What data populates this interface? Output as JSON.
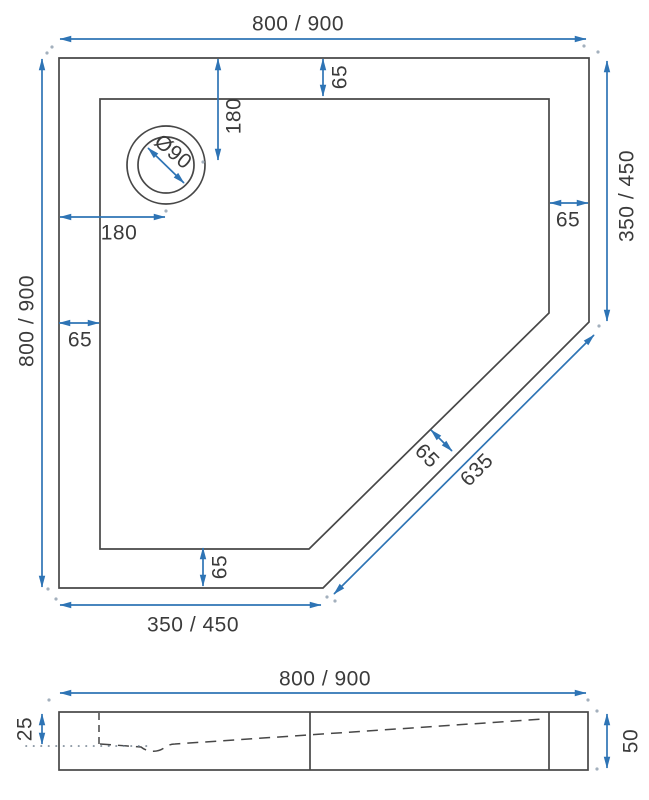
{
  "colors": {
    "outline": "#474747",
    "dimension_accent": "#2e74b5",
    "label_text": "#3b3b3b",
    "background": "#ffffff"
  },
  "top_view": {
    "labels": {
      "overall_width": "800 / 900",
      "overall_height": "800 / 900",
      "right_side": "350 / 450",
      "bottom_side": "350 / 450",
      "diagonal_side": "635",
      "rim_top": "65",
      "rim_left": "65",
      "rim_right": "65",
      "rim_bottom": "65",
      "rim_diagonal": "65",
      "drain_offset_vertical": "180",
      "drain_offset_horizontal": "180",
      "drain_diameter": "Ø90"
    }
  },
  "section_view": {
    "labels": {
      "overall_width": "800 / 900",
      "rim_height": "25",
      "total_height": "50"
    }
  }
}
